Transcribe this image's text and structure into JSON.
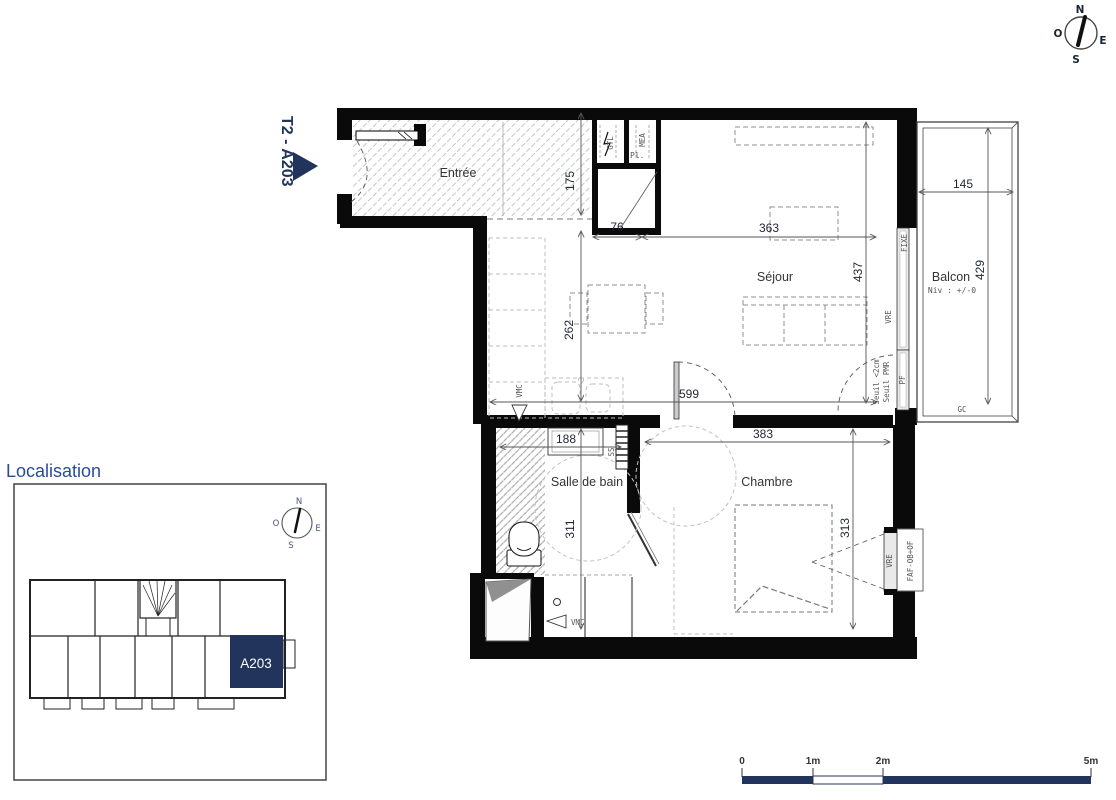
{
  "title_block": {
    "unit_label": "T2 -  A203"
  },
  "compass": {
    "north": "N",
    "east": "E",
    "south": "S",
    "west": "O"
  },
  "rooms": {
    "entree": "Entrée",
    "sejour": "Séjour",
    "balcon": "Balcon",
    "balcon_level": "Niv : +/-0",
    "salle_de_bain": "Salle de bain",
    "chambre": "Chambre",
    "placard": "Pl."
  },
  "dimensions_cm": {
    "entree_depth": "175",
    "placard_width": "76",
    "sejour_width": "363",
    "sejour_depth": "437",
    "cuisine_depth": "262",
    "sejour_total_width": "599",
    "balcon_width": "145",
    "balcon_depth": "429",
    "sdb_width": "188",
    "sdb_depth": "311",
    "chambre_width": "383",
    "chambre_depth": "313"
  },
  "technical_labels": {
    "gtl": "GTL",
    "mea": "MEA",
    "fixe": "FIXE",
    "vre_sejour": "VRE",
    "pf": "PF",
    "seuil_2cm": "Seuil <2cm",
    "seuil_pmr": "Seuil PMR",
    "ss": "SS",
    "vmc_cuisine": "VMC",
    "vmc_sdb": "VMC",
    "gc": "GC",
    "vre_chambre": "VRE",
    "faf": "FAF-OB+OF"
  },
  "localisation": {
    "title": "Localisation",
    "highlighted_unit": "A203"
  },
  "scale_bar": {
    "labels": [
      "0",
      "1m",
      "2m",
      "5m"
    ]
  },
  "colors": {
    "accent_navy": "#22345c",
    "heading_blue": "#2a4b9c",
    "wall_black": "#0a0a0a"
  }
}
